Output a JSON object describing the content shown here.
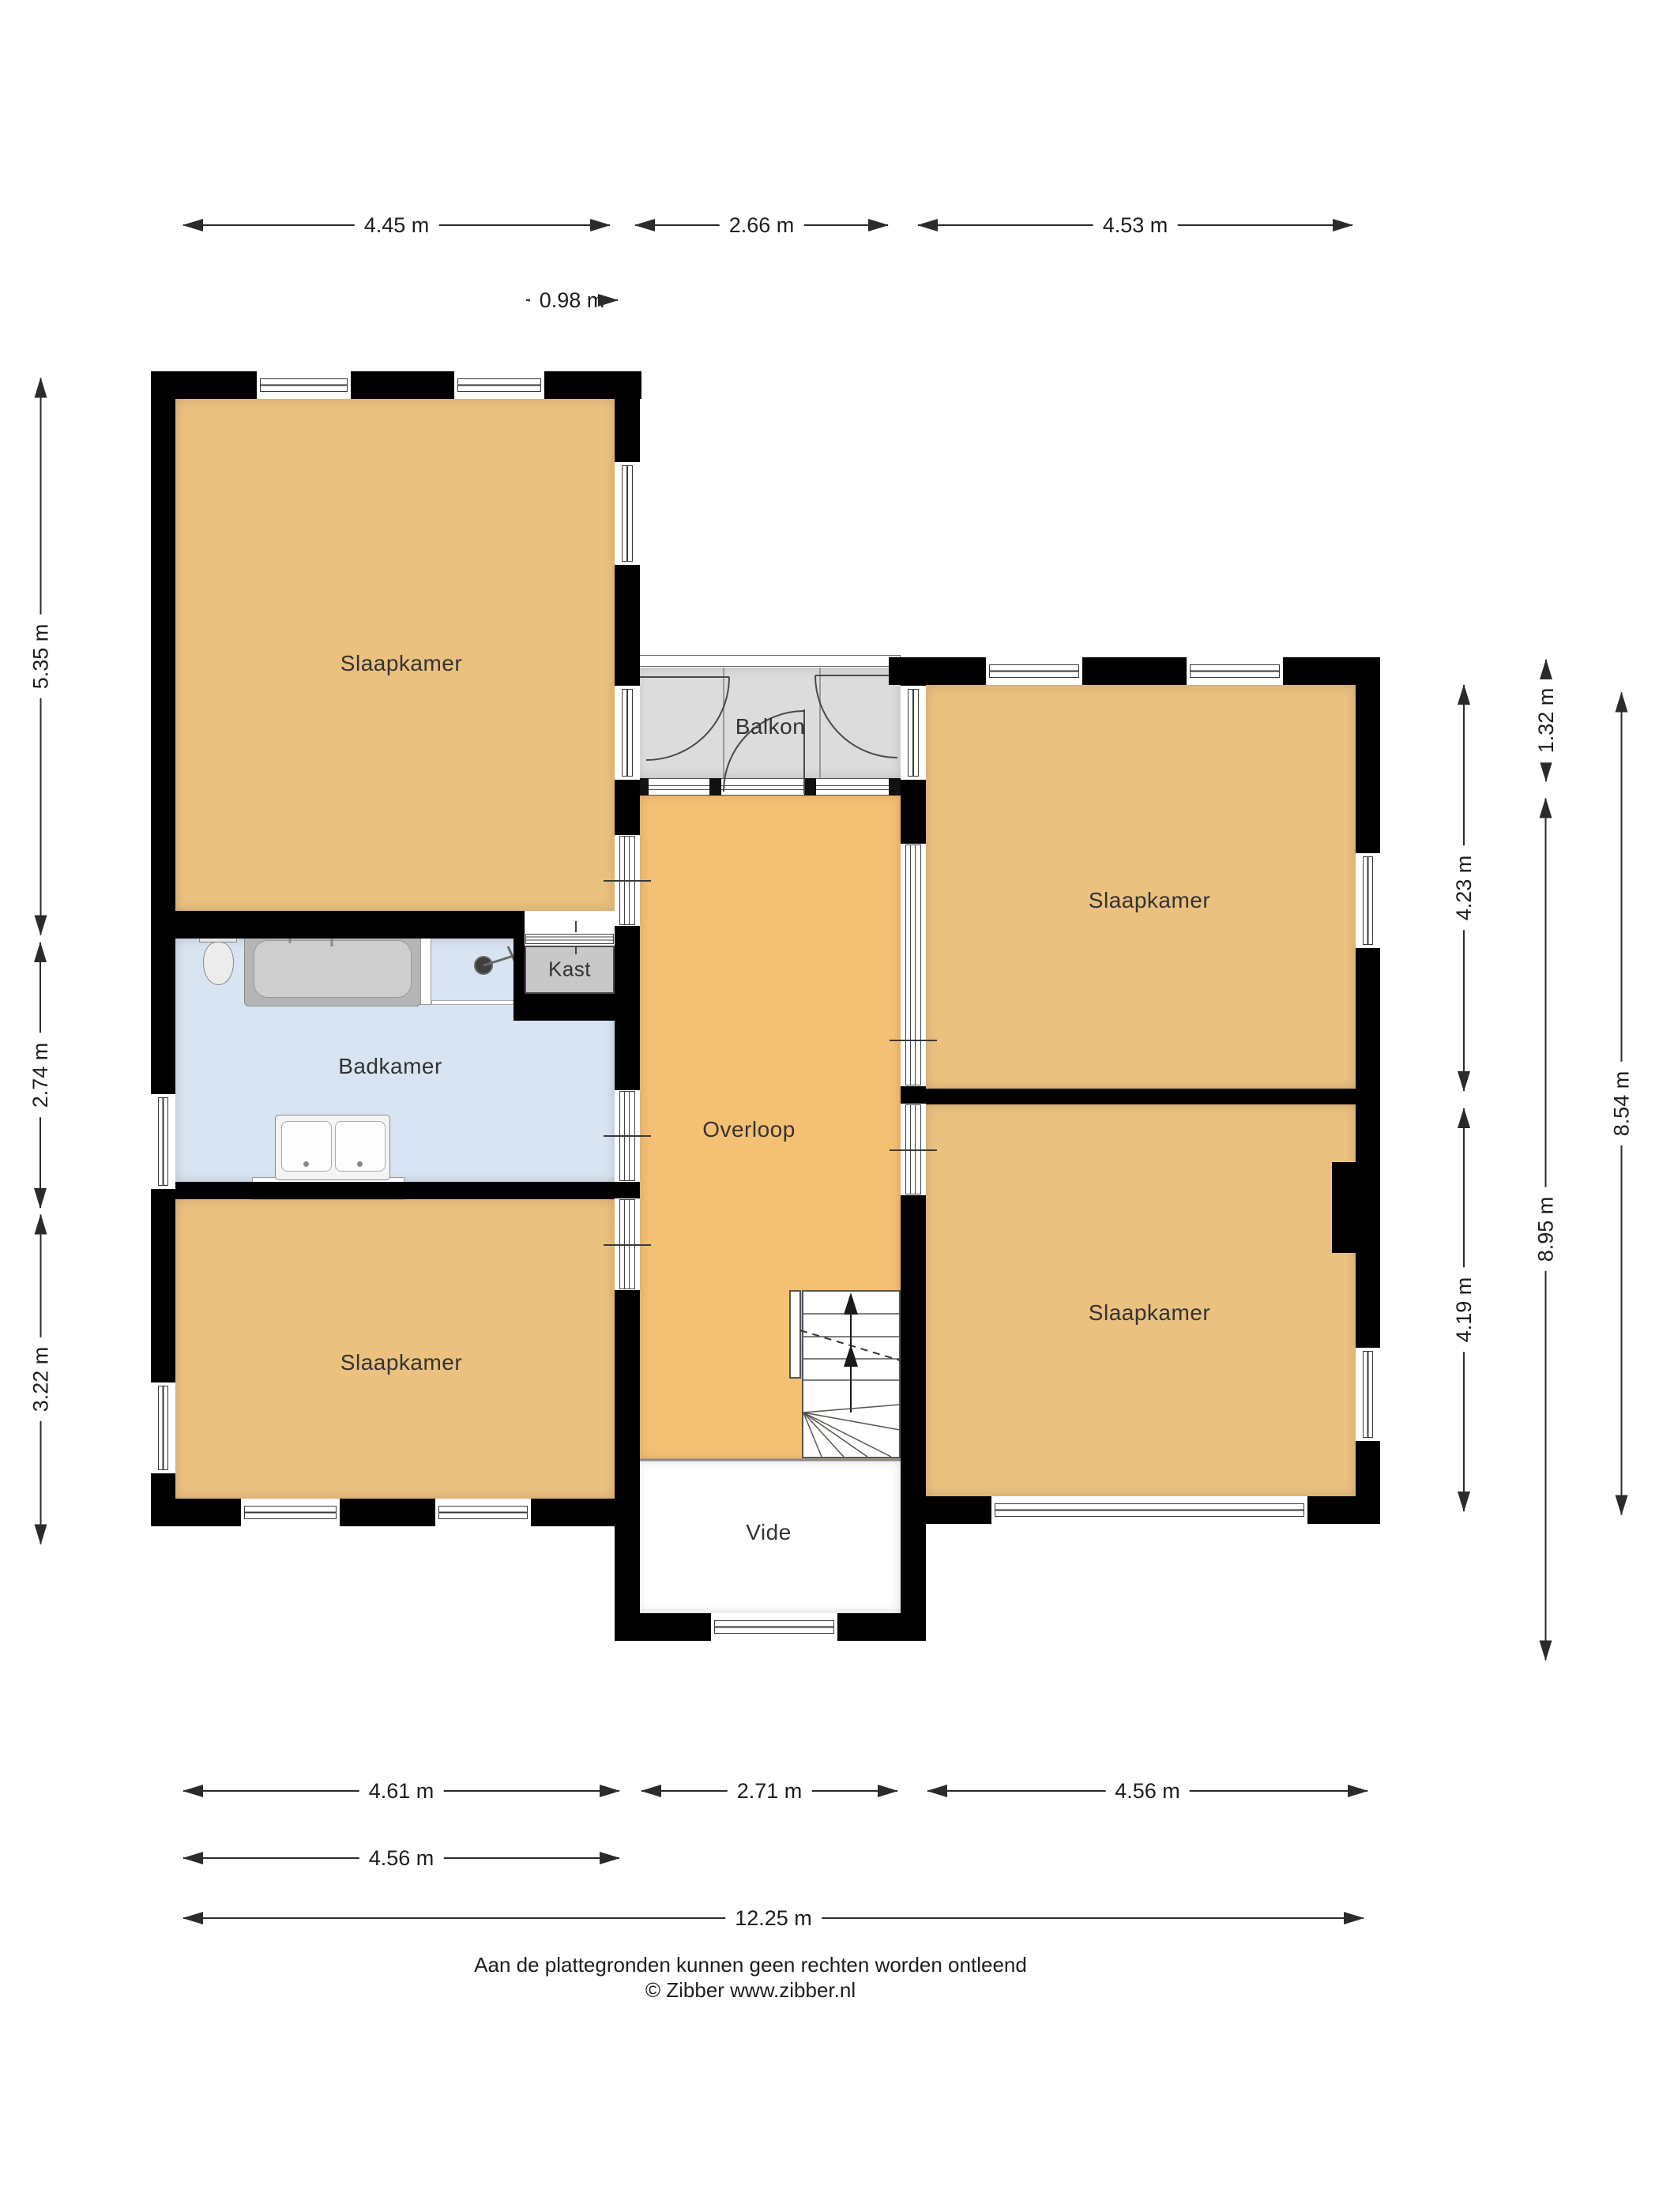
{
  "floorplan": {
    "rooms": {
      "bedroom_top_left": {
        "label": "Slaapkamer"
      },
      "bedroom_top_right": {
        "label": "Slaapkamer"
      },
      "bedroom_bottom_left": {
        "label": "Slaapkamer"
      },
      "bedroom_bottom_right": {
        "label": "Slaapkamer"
      },
      "bathroom": {
        "label": "Badkamer"
      },
      "landing": {
        "label": "Overloop"
      },
      "balcony": {
        "label": "Balkon"
      },
      "closet": {
        "label": "Kast"
      },
      "void": {
        "label": "Vide"
      }
    },
    "dimensions": {
      "top": [
        {
          "label": "4.45 m"
        },
        {
          "label": "2.66 m"
        },
        {
          "label": "4.53 m"
        }
      ],
      "top_small": {
        "label": "0.98 m"
      },
      "left": [
        {
          "label": "5.35 m"
        },
        {
          "label": "2.74 m"
        },
        {
          "label": "3.22 m"
        }
      ],
      "right_inner": [
        {
          "label": "4.23 m"
        },
        {
          "label": "4.19 m"
        }
      ],
      "right_middle": [
        {
          "label": "1.32 m"
        },
        {
          "label": "8.95 m"
        }
      ],
      "right_outer": [
        {
          "label": "8.54 m"
        }
      ],
      "bottom_row1": [
        {
          "label": "4.61 m"
        },
        {
          "label": "2.71 m"
        },
        {
          "label": "4.56 m"
        }
      ],
      "bottom_row2": [
        {
          "label": "4.56 m"
        }
      ],
      "bottom_row3": [
        {
          "label": "12.25 m"
        }
      ]
    },
    "footer": {
      "line1": "Aan de plattegronden kunnen geen rechten worden ontleend",
      "line2": "© Zibber www.zibber.nl"
    },
    "colors": {
      "room_tan": "#ebc180",
      "hall_tan": "#f4c074",
      "bath_blue": "#d8e4f1",
      "balcony_gray": "#dcdcdc",
      "closet_gray": "#c8c8c8",
      "wall": "#000000"
    }
  }
}
